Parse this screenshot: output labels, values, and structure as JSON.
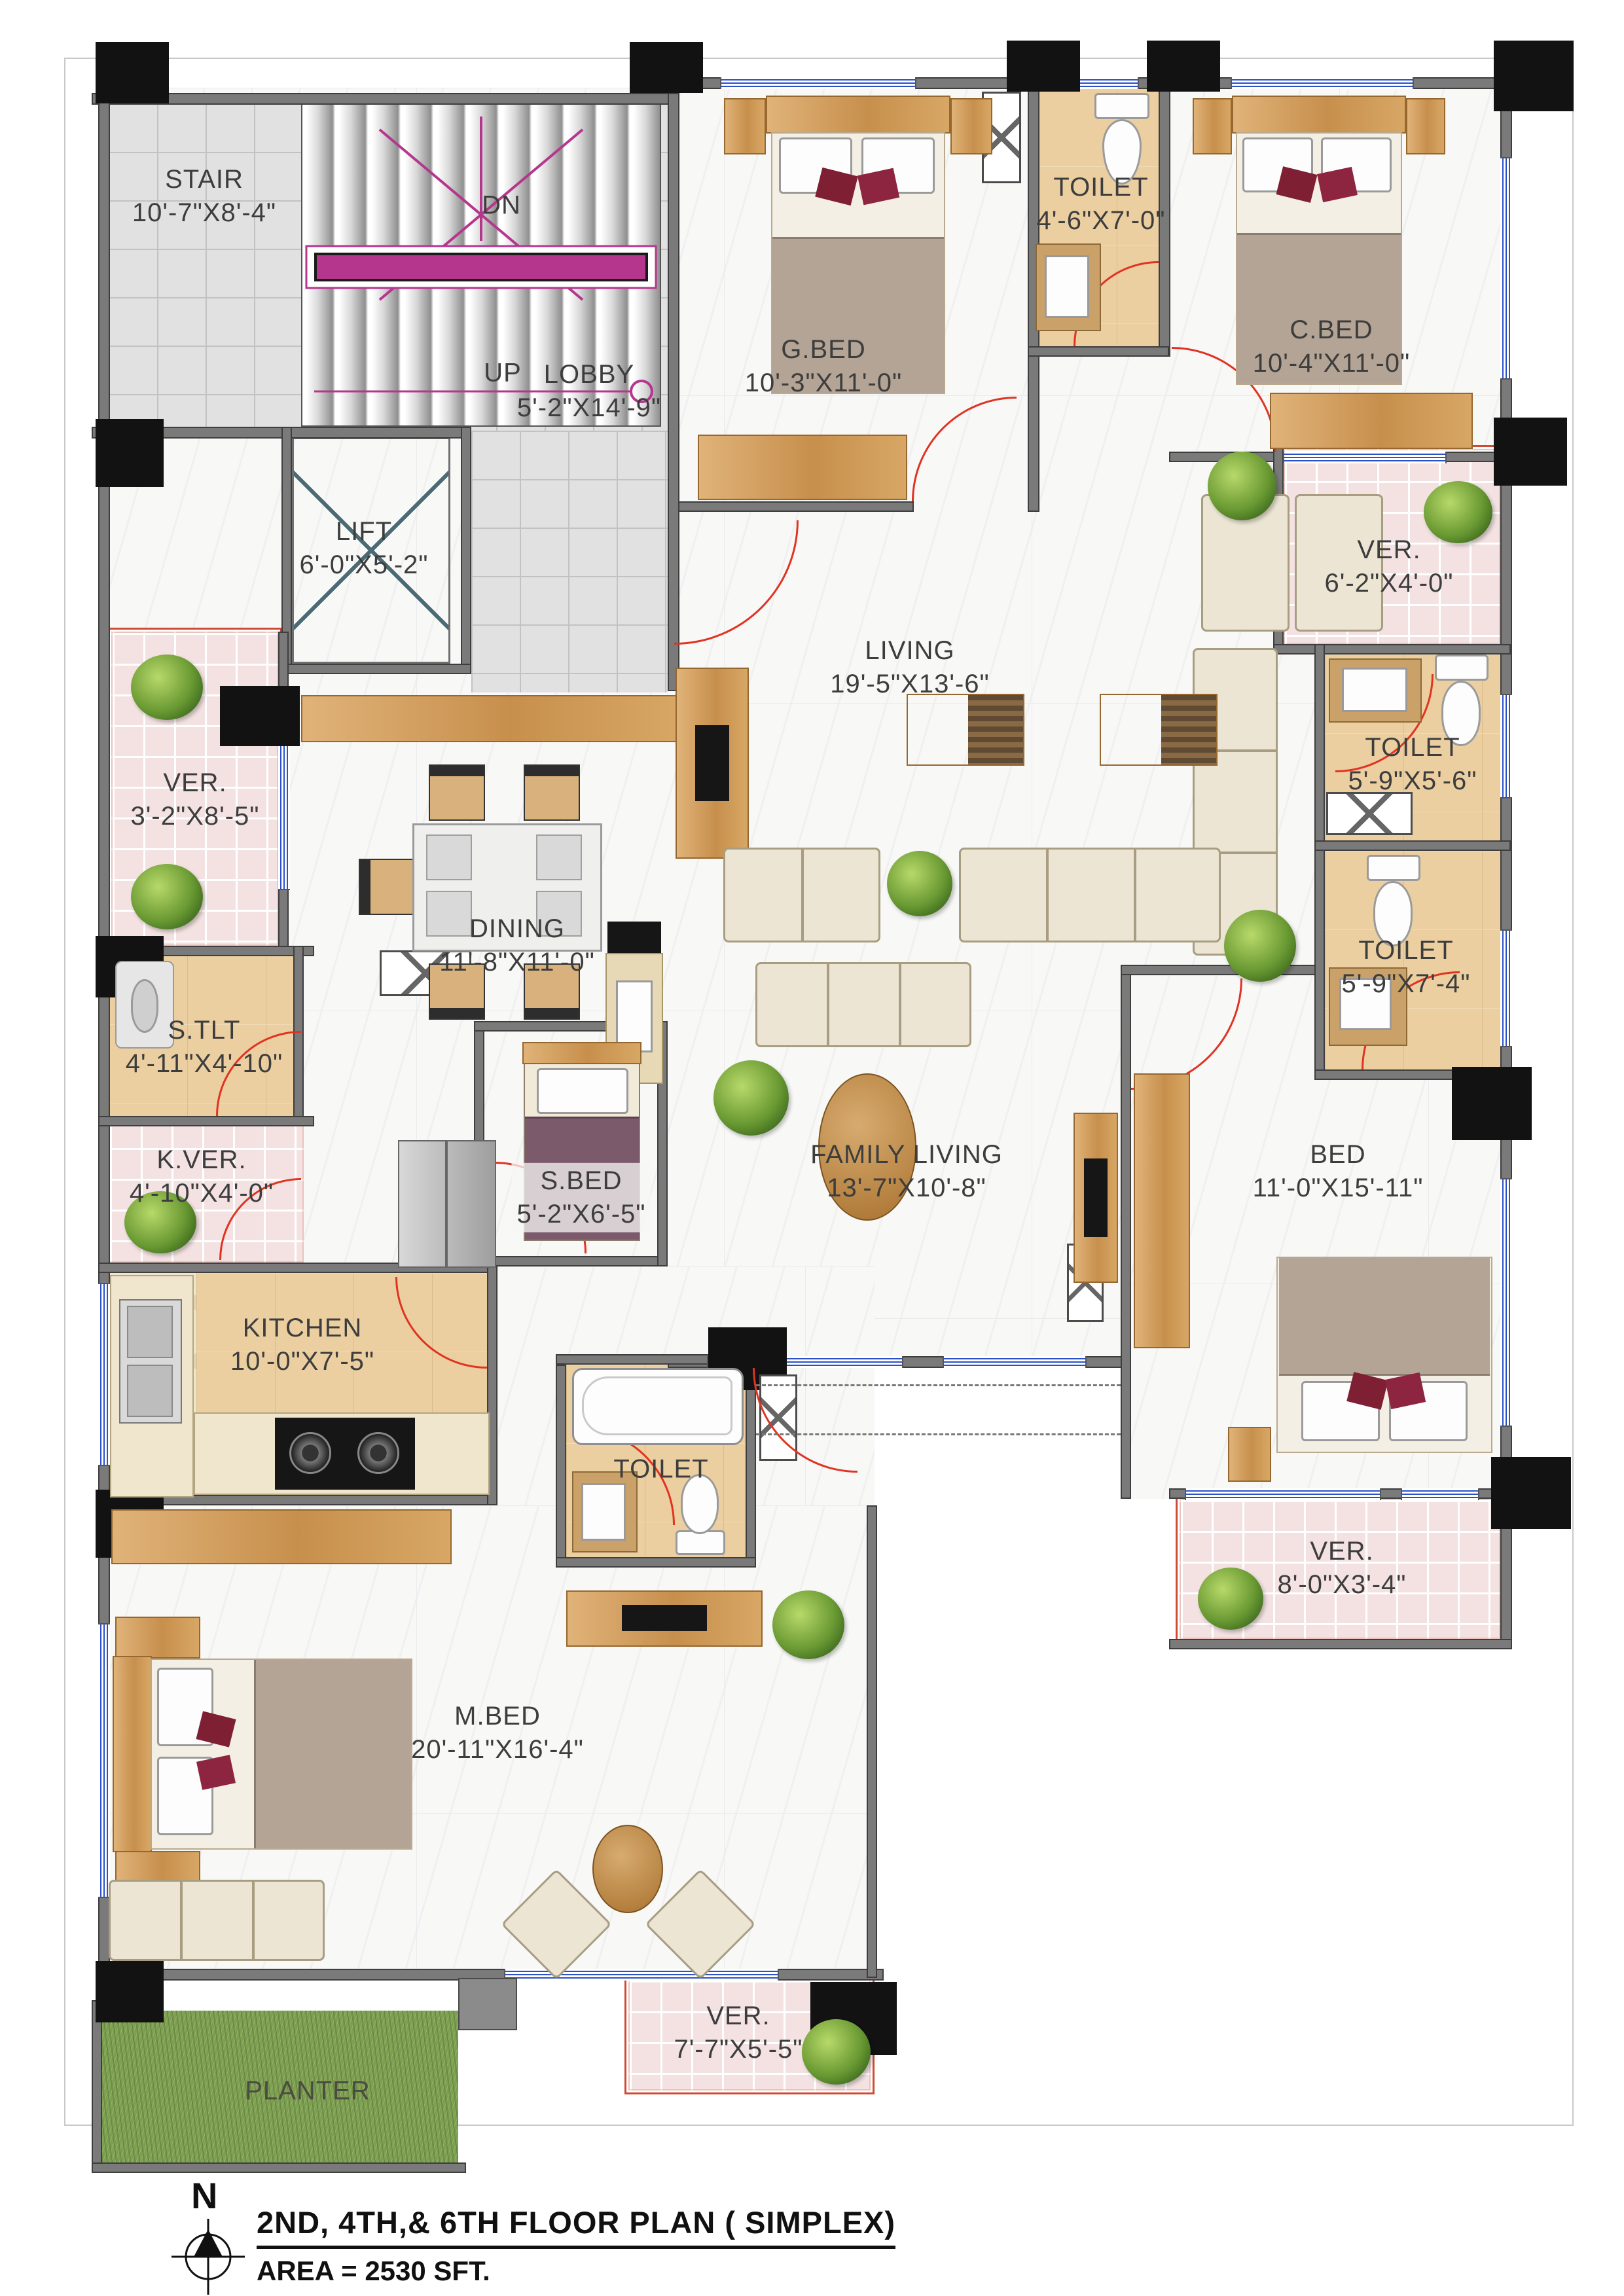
{
  "meta": {
    "drawing_type": "floor-plan",
    "colors": {
      "wall": "#7a7a7a",
      "column": "#121212",
      "door": "#e03322",
      "window_blue": "#2b50c8",
      "veranda_pink": "#f4e2e2",
      "toilet_tan": "#eccfa0",
      "wood": "#c78f4c",
      "stair_magenta": "#b5368d",
      "grass": "#7ea052"
    }
  },
  "rooms": [
    {
      "id": "stair",
      "name": "STAIR",
      "dims": "10'-7\"X8'-4\""
    },
    {
      "id": "lobby",
      "name": "LOBBY",
      "dims": "5'-2\"X14'-9\""
    },
    {
      "id": "lift",
      "name": "LIFT",
      "dims": "6'-0\"X5'-2\""
    },
    {
      "id": "gbed",
      "name": "G.BED",
      "dims": "10'-3\"X11'-0\""
    },
    {
      "id": "toilet-top",
      "name": "TOILET",
      "dims": "4'-6\"X7'-0\""
    },
    {
      "id": "cbed",
      "name": "C.BED",
      "dims": "10'-4\"X11'-0\""
    },
    {
      "id": "ver-top-right",
      "name": "VER.",
      "dims": "6'-2\"X4'-0\""
    },
    {
      "id": "toilet-right-1",
      "name": "TOILET",
      "dims": "5'-9\"X5'-6\""
    },
    {
      "id": "toilet-right-2",
      "name": "TOILET",
      "dims": "5'-9\"X7'-4\""
    },
    {
      "id": "living",
      "name": "LIVING",
      "dims": "19'-5\"X13'-6\""
    },
    {
      "id": "dining",
      "name": "DINING",
      "dims": "11'-8\"X11'-0\""
    },
    {
      "id": "ver-left",
      "name": "VER.",
      "dims": "3'-2\"X8'-5\""
    },
    {
      "id": "stlt",
      "name": "S.TLT",
      "dims": "4'-11\"X4'-10\""
    },
    {
      "id": "kver",
      "name": "K.VER.",
      "dims": "4'-10\"X4'-0\""
    },
    {
      "id": "sbed",
      "name": "S.BED",
      "dims": "5'-2\"X6'-5\""
    },
    {
      "id": "kitchen",
      "name": "KITCHEN",
      "dims": "10'-0\"X7'-5\""
    },
    {
      "id": "family",
      "name": "FAMILY LIVING",
      "dims": "13'-7\"X10'-8\""
    },
    {
      "id": "bed",
      "name": "BED",
      "dims": "11'-0\"X15'-11\""
    },
    {
      "id": "ver-bottom-right",
      "name": "VER.",
      "dims": "8'-0\"X3'-4\""
    },
    {
      "id": "toilet-master",
      "name": "TOILET",
      "dims": ""
    },
    {
      "id": "mbed",
      "name": "M.BED",
      "dims": "20'-11\"X16'-4\""
    },
    {
      "id": "ver-bottom",
      "name": "VER.",
      "dims": "7'-7\"X5'-5\""
    },
    {
      "id": "planter",
      "name": "PLANTER",
      "dims": ""
    }
  ],
  "annotations": {
    "dn": "DN",
    "up": "UP",
    "north": "N"
  },
  "footer": {
    "title": "2ND, 4TH,& 6TH FLOOR PLAN ( SIMPLEX)",
    "area": "AREA = 2530 SFT."
  }
}
